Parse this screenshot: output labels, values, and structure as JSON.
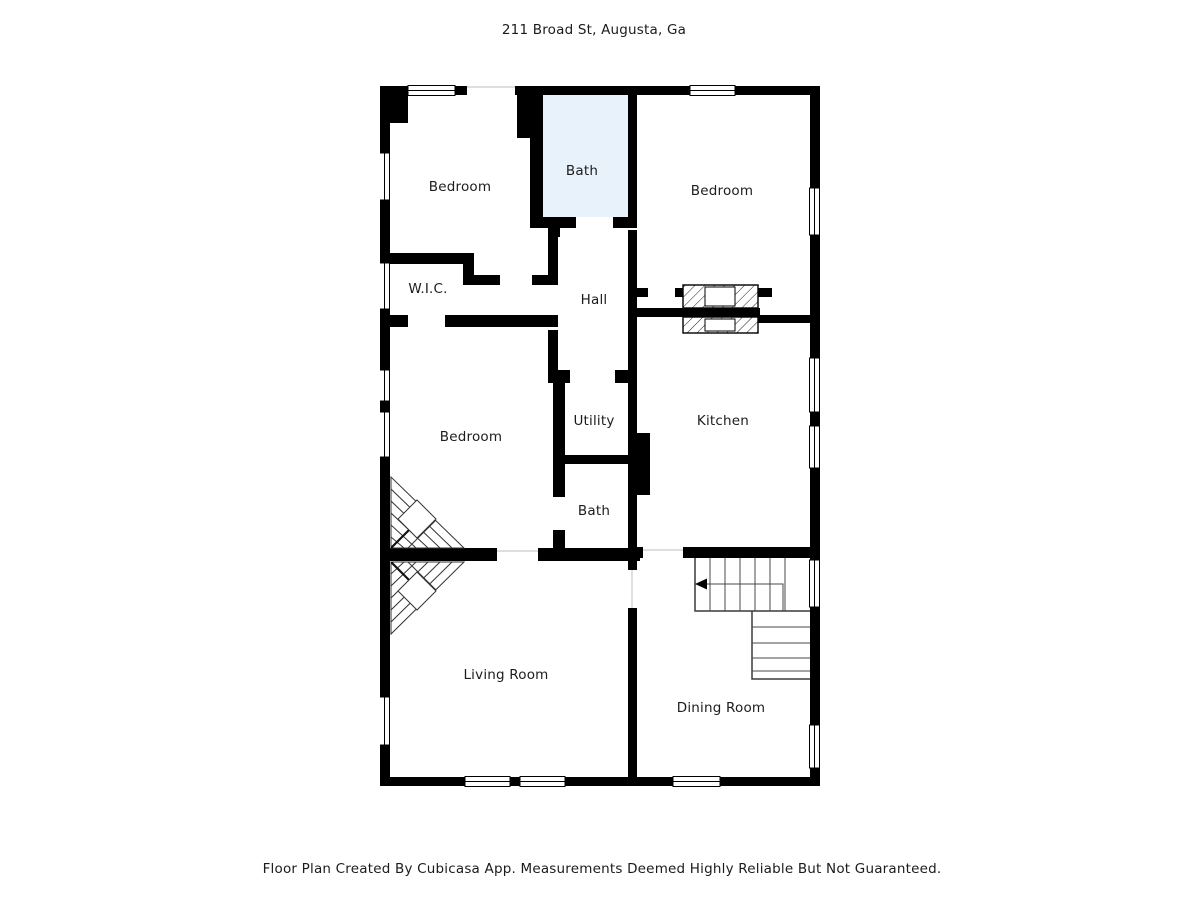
{
  "header": {
    "title": "211 Broad St, Augusta, Ga"
  },
  "footer": {
    "disclaimer": "Floor Plan Created By Cubicasa App. Measurements Deemed Highly Reliable But Not Guaranteed."
  },
  "floorplan": {
    "colors": {
      "wall": "#000000",
      "bath_fill": "#e8f2fb",
      "stair_line": "#4a4a4a",
      "background": "#ffffff"
    },
    "rooms": [
      {
        "label": "Bedroom",
        "x": 460,
        "y": 187
      },
      {
        "label": "Bath",
        "x": 582,
        "y": 171
      },
      {
        "label": "Bedroom",
        "x": 722,
        "y": 191
      },
      {
        "label": "W.I.C.",
        "x": 428,
        "y": 289
      },
      {
        "label": "Hall",
        "x": 594,
        "y": 300
      },
      {
        "label": "Bedroom",
        "x": 471,
        "y": 437
      },
      {
        "label": "Utility",
        "x": 594,
        "y": 421
      },
      {
        "label": "Kitchen",
        "x": 723,
        "y": 421
      },
      {
        "label": "Bath",
        "x": 594,
        "y": 511
      },
      {
        "label": "Living Room",
        "x": 506,
        "y": 675
      },
      {
        "label": "Dining Room",
        "x": 721,
        "y": 708
      }
    ],
    "features": {
      "staircase_arrow": "up-direction-arrow-icon",
      "chimney": "hatched-chimney",
      "winder_stairs": "diagonal-winder-stairs"
    }
  }
}
